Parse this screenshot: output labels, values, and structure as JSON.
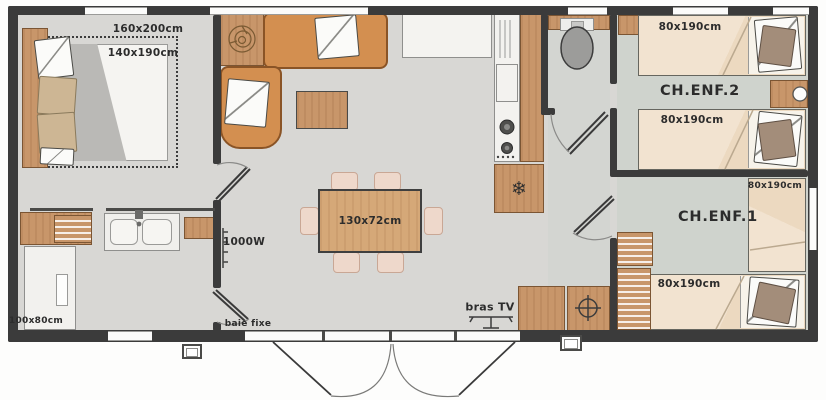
{
  "floorplan": {
    "labels": {
      "master_zone": "160x200cm",
      "master_bed": "140x190cm",
      "dining_table": "130x72cm",
      "heater": "1000W",
      "fixed_bay": "baie fixe",
      "tv_arm": "bras TV",
      "shower": "100x80cm",
      "room2_name": "CH.ENF.2",
      "room1_name": "CH.ENF.1",
      "bed_r2_top": "80x190cm",
      "bed_r2_bottom": "80x190cm",
      "bed_r1_right": "80x190cm",
      "bed_r1_bottom": "80x190cm"
    },
    "icons": {
      "fridge": "snowflake-icon",
      "water_heater": "circle-cross-icon",
      "decor": "spiral-coil-icon",
      "toilet": "toilet-icon",
      "lamp": "round-lamp-icon"
    },
    "colors": {
      "wall": "#3b3b3b",
      "floor": "#d8d7d4",
      "room_floor": "#cfd3cd",
      "wood": "#c8966a",
      "sofa": "#d38f50",
      "bed_linen": "#f0dfca",
      "chair": "#eed8cb",
      "cushion": "#a38d7a"
    }
  }
}
